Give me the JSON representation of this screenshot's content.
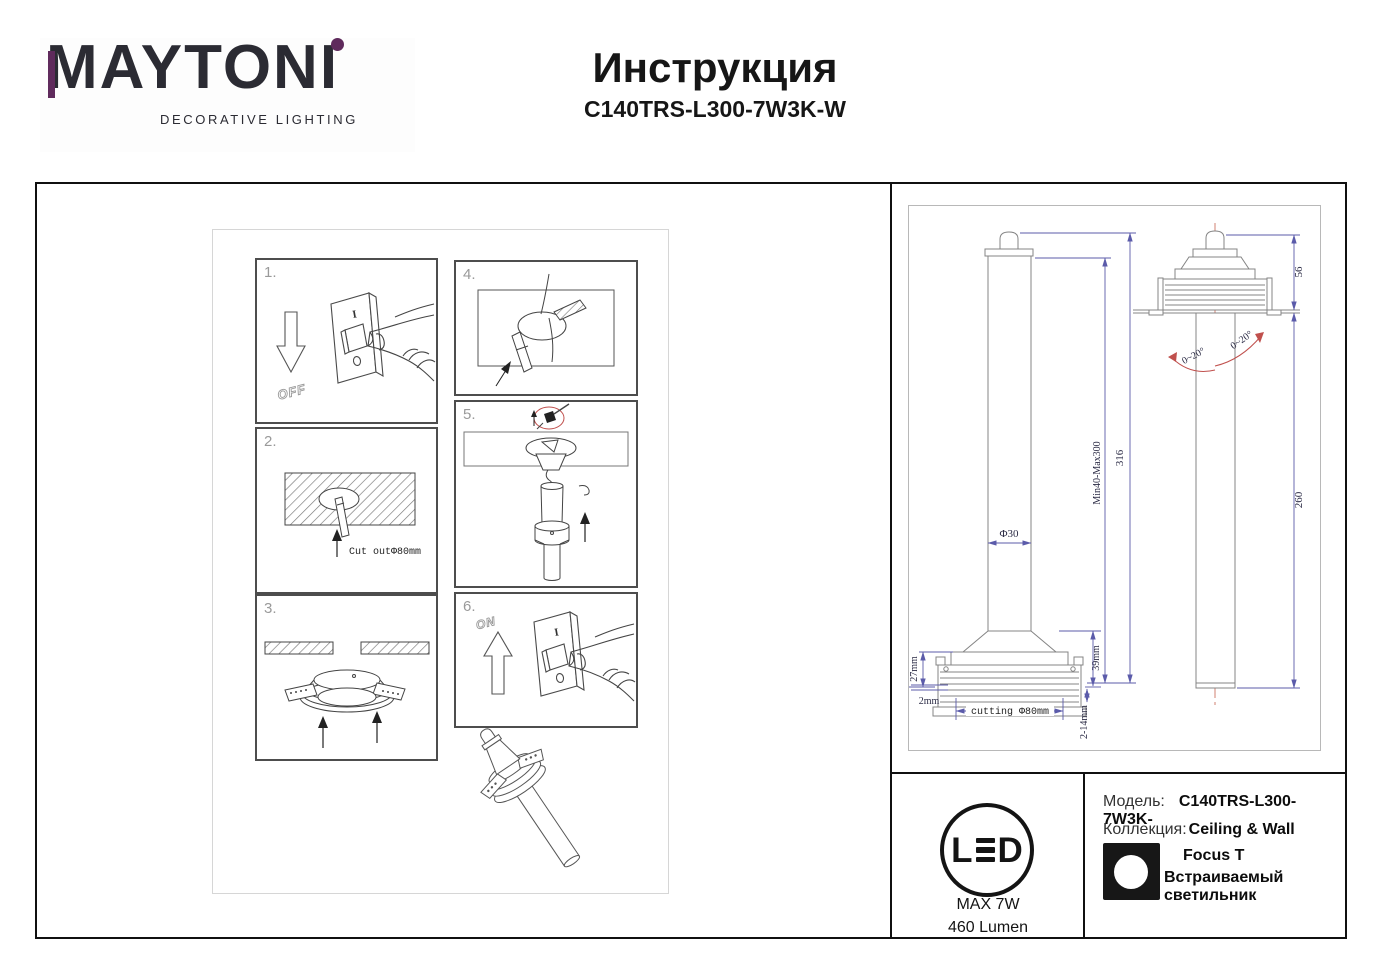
{
  "header": {
    "logo": "MAYTONI",
    "logo_sub": "DECORATIVE LIGHTING",
    "title": "Инструкция",
    "model": "C140TRS-L300-7W3K-W"
  },
  "colors": {
    "brand_purple": "#5f2a5c",
    "dim_blue": "#5b5baa",
    "accent_red": "#c0504d"
  },
  "steps": {
    "s1": {
      "num": "1.",
      "off_label": "OFF",
      "switch_on": "I",
      "switch_off": "0"
    },
    "s2": {
      "num": "2.",
      "note": "Cut outΦ80mm"
    },
    "s3": {
      "num": "3."
    },
    "s4": {
      "num": "4."
    },
    "s5": {
      "num": "5."
    },
    "s6": {
      "num": "6.",
      "on_label": "ON",
      "switch_on": "I",
      "switch_off": "0"
    }
  },
  "tech": {
    "front": {
      "dia_tube": "Φ30",
      "height_left": "27mm",
      "lip": "2mm",
      "cutting": "cutting Φ80mm",
      "height_right": "39mm",
      "ceiling_range": "2-14mm",
      "adjust_range": "Min40-Max300",
      "total_height": "316"
    },
    "side": {
      "above_ceiling": "56",
      "below_ceiling": "260",
      "angle_left": "0~20°",
      "angle_right": "0~20°"
    }
  },
  "footer": {
    "led": {
      "l": "L",
      "d": "D",
      "max_power": "MAX 7W",
      "lumen": "460 Lumen"
    },
    "model_label": "Модель:",
    "model_value": "C140TRS-L300-7W3K-",
    "collection_label": "Коллекция:",
    "collection_value": "Ceiling & Wall",
    "family_name": "Focus T",
    "family_type": "Встраиваемый светильник"
  }
}
